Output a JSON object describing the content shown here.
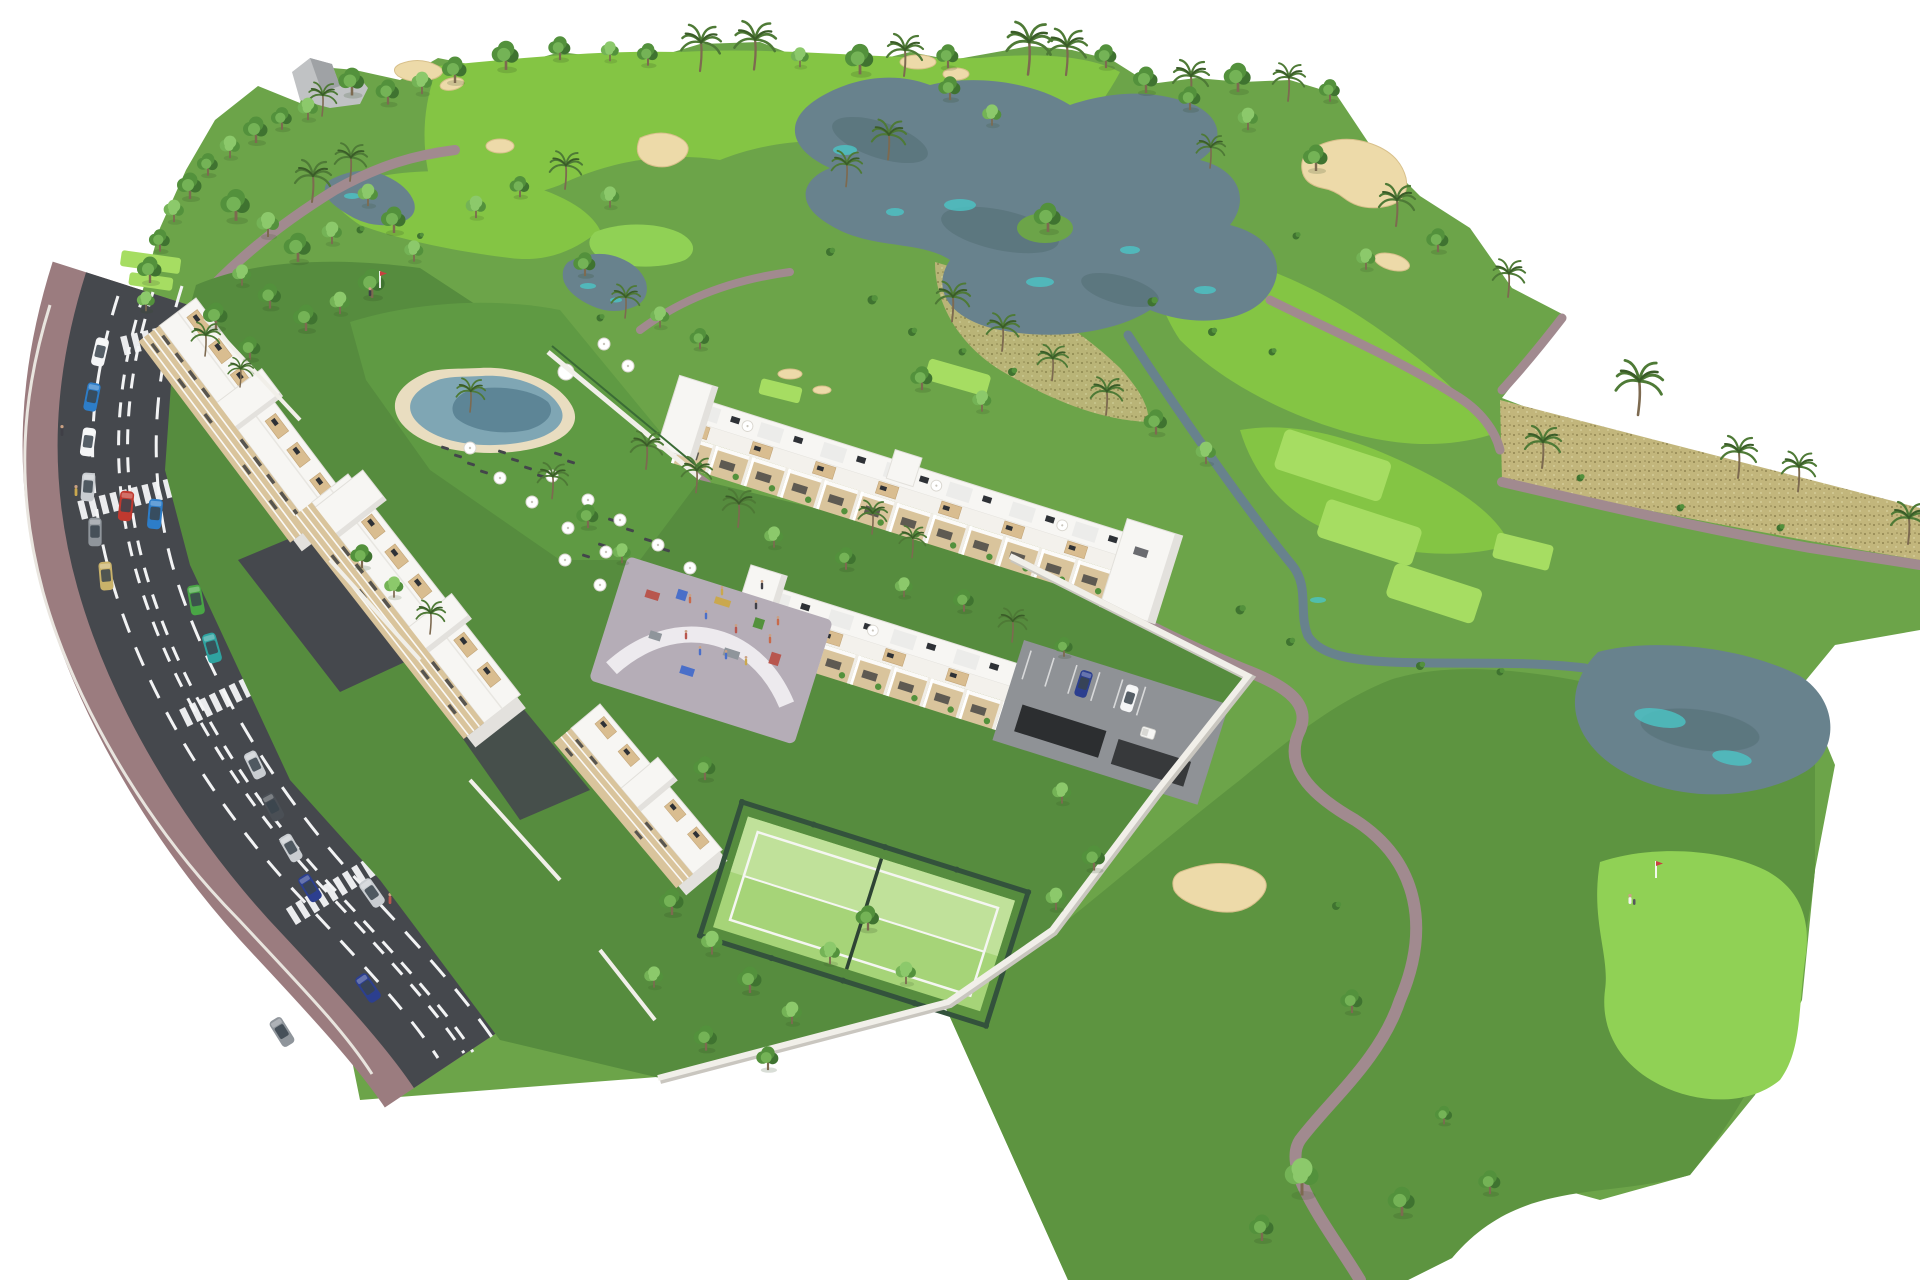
{
  "description": "Aerial 3D architectural rendering of a golf-resort residential masterplan on a white background: white apartment blocks and two long townhouse rows with roof terraces, a lagoon pool with umbrellas, a playground plaza, a padel court and walled gardens, beside a golf course with gray-blue lakes, sand bunkers, bright tee boxes, putting greens with flags, winding paths, palms and trees; a curved two-lane road with parked and driving cars, crosswalks and pedestrians runs along the lower-left edge.",
  "features": {
    "golf_course": "golf course with lakes, bunkers, fairways, tees and greens",
    "residential": "white apartment slabs, townhouse rows, pool, playground, padel court",
    "road": "two-lane road with dashed markings, crosswalks, street parking"
  },
  "counts": {
    "flags": 2,
    "crosswalks": 4,
    "street_cars": 14,
    "parked_cars": 10,
    "umbrellas": 17,
    "palm_trees": 34
  },
  "palette": {
    "bg": "#ffffff",
    "grass-base": "#6ca449",
    "grass-dark": "#5d9440",
    "garden": "#568c3e",
    "lawn": "#5f9a43",
    "fairway": "#84c544",
    "tee": "#a6dd62",
    "green-putt": "#90d155",
    "dry-grass": "#c2b67c",
    "dry-speck": "#8f8350",
    "dry-light": "#d9d2a0",
    "sand": "#eddaa9",
    "sand-shadow": "#d8c08b",
    "water": "#68828d",
    "water-dark": "#50696f",
    "water-teal": "#4cc5c6",
    "path": "#a18a8f",
    "road": "#45484d",
    "road-line": "#f2f3f4",
    "sidewalk": "#9b7c7f",
    "curb": "#e9e5df",
    "building-white": "#f7f6f3",
    "building-shade": "#e3e1dd",
    "building-cream": "#d9c49c",
    "building-wood": "#c9a472",
    "window-dark": "#2e3136",
    "pergola-tan": "#d9bd90",
    "wall-white": "#f1efe9",
    "wall-shadow": "#c9c6bf",
    "pool-water": "#7fa6b4",
    "pool-deep": "#5d8596",
    "pool-deck": "#e9ddc0",
    "plaza": "#b5adb7",
    "plaza-light": "#edeaee",
    "padel-court": "#a6d478",
    "padel-court-light": "#c0e19a",
    "padel-fence": "#33523c",
    "tree-dark": "#3f7330",
    "tree-mid": "#53913c",
    "tree-light": "#74b356",
    "tree-bright": "#8cc96b",
    "palm-frond": "#4e7a36",
    "palm-dark": "#3a5c28",
    "trunk": "#7d6a50",
    "rock": "#c0c2c4",
    "rock-shadow": "#9fa2a5",
    "car-red": "#c0392f",
    "car-blue": "#2d7dc8",
    "car-teal": "#2fa3a0",
    "car-green": "#49a545",
    "car-silver": "#c9cdd1",
    "car-gray": "#8f959b",
    "car-navy": "#2c3f8f",
    "car-white": "#f4f5f6",
    "car-dark": "#4a4f55",
    "car-gold": "#c9b26a",
    "flag-pennant": "#c94040",
    "person-a": "#c96a4a",
    "person-b": "#4a6fc9",
    "person-c": "#caa84e",
    "person-d": "#b8564e",
    "person-e": "#3f3f46"
  }
}
